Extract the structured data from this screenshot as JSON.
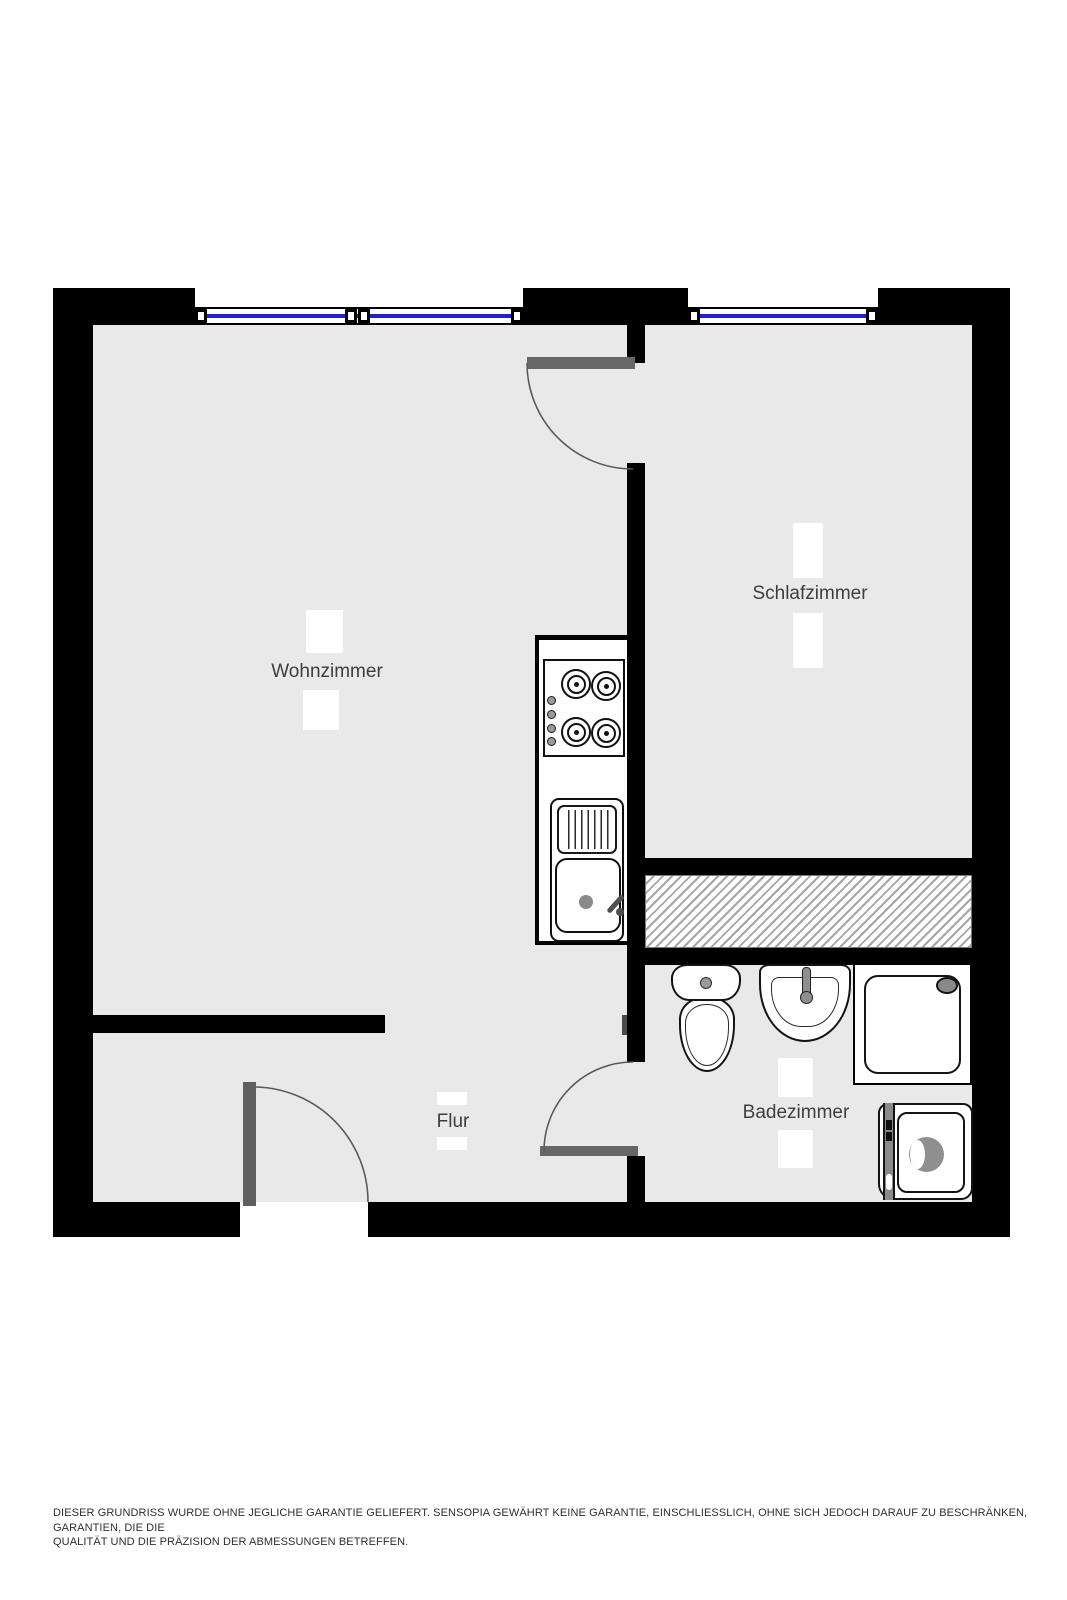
{
  "plan": {
    "title": "Grundriss (floor plan)",
    "rooms": [
      {
        "id": "wohnzimmer",
        "label": "Wohnzimmer"
      },
      {
        "id": "schlafzimmer",
        "label": "Schlafzimmer"
      },
      {
        "id": "flur",
        "label": "Flur"
      },
      {
        "id": "badezimmer",
        "label": "Badezimmer"
      }
    ],
    "fixtures": [
      "stove-cooktop",
      "kitchen-sink",
      "toilet",
      "washbasin",
      "shower",
      "washing-machine"
    ],
    "windows": [
      {
        "room": "Wohnzimmer"
      },
      {
        "room": "Schlafzimmer"
      }
    ],
    "doors": [
      {
        "from": "Wohnzimmer",
        "to": "Schlafzimmer"
      },
      {
        "from": "Flur",
        "to": "Badezimmer"
      },
      {
        "from": "outside",
        "to": "Flur"
      }
    ],
    "colors": {
      "wall": "#000000",
      "floor": "#e9e9e9",
      "window_glass": "#2121cf",
      "door_leaf": "#676767",
      "hatch_line": "#a6a6a6",
      "fixture_gray": "#8a8a8a",
      "label_text": "#3e3e3e",
      "disclaimer_text": "#2f2f2f"
    }
  },
  "disclaimer": {
    "line1": "DIESER GRUNDRISS WURDE OHNE JEGLICHE GARANTIE GELIEFERT. SENSOPIA GEWÄHRT KEINE GARANTIE, EINSCHLIESSLICH, OHNE SICH JEDOCH DARAUF ZU BESCHRÄNKEN, GARANTIEN, DIE DIE",
    "line2": "QUALITÄT UND DIE PRÄZISION DER ABMESSUNGEN BETREFFEN."
  }
}
